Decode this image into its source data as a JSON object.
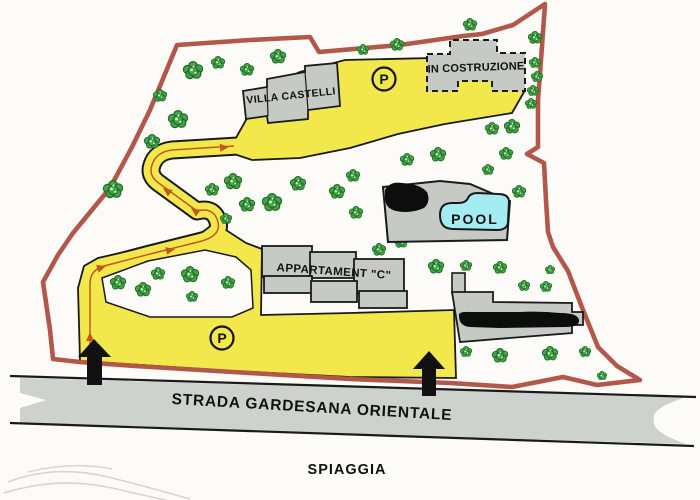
{
  "labels": {
    "villa": "VILLA CASTELLI",
    "construction": "IN COSTRUZIONE",
    "pool": "POOL",
    "apartment": "APPARTAMENT \"C\"",
    "parking": "P",
    "road": "STRADA GARDESANA ORIENTALE",
    "beach": "SPIAGGIA"
  },
  "colors": {
    "boundary": "#b2584a",
    "path_fill": "#f2e84b",
    "outline": "#1a1a1a",
    "building_fill": "#c6cac4",
    "pool_water": "#a5ebf2",
    "road_fill": "#cdd2cc",
    "arrow_line": "#c4581c",
    "tree_fill": "#46a34a",
    "tree_outline": "#1d6b21"
  }
}
